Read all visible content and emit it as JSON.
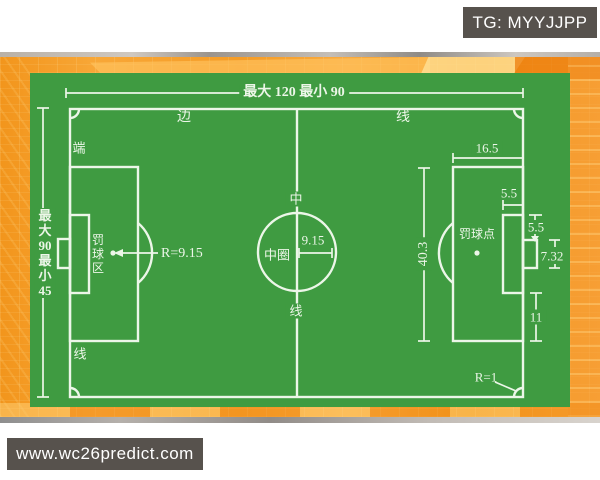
{
  "badges": {
    "telegram": "TG: MYYJJPP",
    "website": "www.wc26predict.com"
  },
  "colors": {
    "field_green": "#3F9B41",
    "line_white": "#ECF6E8",
    "orange_base": "#F79C2D",
    "badge_gray": "#57524D"
  },
  "field": {
    "length_dim": "最大 120 最小 90",
    "width_chars": [
      "最",
      "大",
      "90",
      "最",
      "小",
      "45"
    ],
    "touchline_char1": "边",
    "touchline_char2": "线",
    "goal_line_char1": "端",
    "goal_line_char2": "线",
    "halfway_char1": "中",
    "halfway_char2": "线",
    "center_circle_label": "中圈",
    "center_circle_radius": "9.15",
    "penalty_arc_radius": "R=9.15",
    "penalty_area_chars": [
      "罚",
      "球",
      "区"
    ],
    "penalty_spot_label": "罚球点",
    "dims": {
      "penalty_area_depth": "16.5",
      "goal_area_depth": "5.5",
      "goal_post_offset": "5.5",
      "goal_width": "7.32",
      "goal_area_to_penalty_edge": "11",
      "penalty_area_width": "40.3",
      "corner_arc_radius": "R=1"
    }
  }
}
